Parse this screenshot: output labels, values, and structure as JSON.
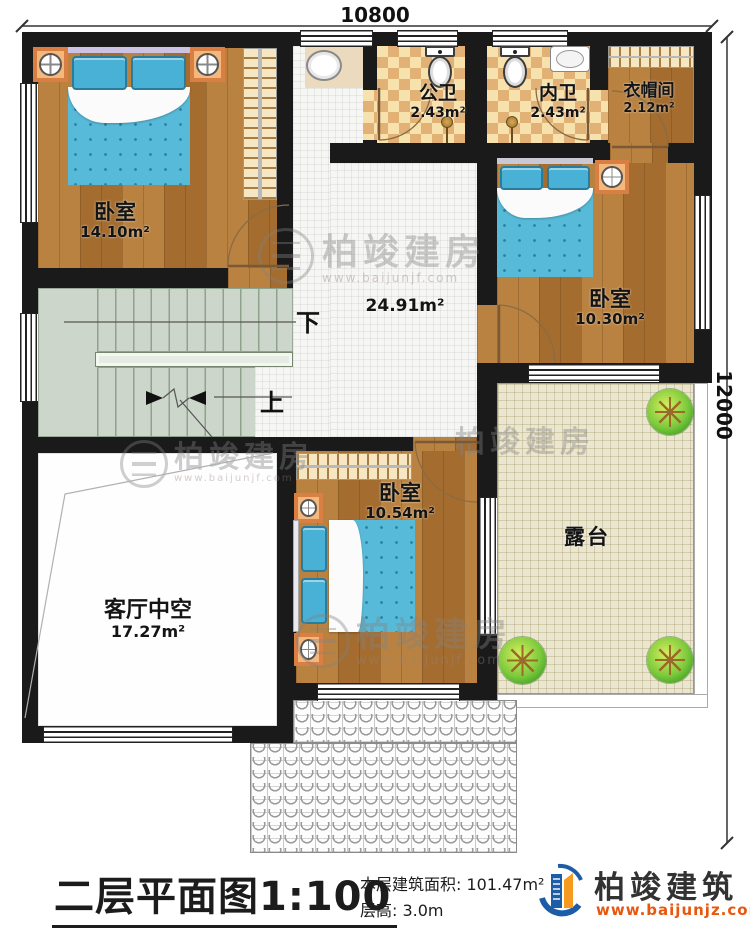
{
  "dimensions": {
    "top": "10800",
    "right": "12000"
  },
  "rooms": {
    "bedroom_tl": {
      "name": "卧室",
      "area": "14.10m²"
    },
    "bath_public": {
      "name": "公卫",
      "area": "2.43m²"
    },
    "bath_ensuite": {
      "name": "内卫",
      "area": "2.43m²"
    },
    "cloakroom": {
      "name": "衣帽间",
      "area": "2.12m²"
    },
    "bedroom_right": {
      "name": "卧室",
      "area": "10.30m²"
    },
    "hall": {
      "area": "24.91m²"
    },
    "bedroom_bottom": {
      "name": "卧室",
      "area": "10.54m²"
    },
    "living_void": {
      "name": "客厅中空",
      "area": "17.27m²"
    },
    "terrace": {
      "name": "露台"
    }
  },
  "stairs": {
    "down": "下",
    "up": "上"
  },
  "watermark": {
    "text": "柏竣建房",
    "url": "www.baijunjf.com"
  },
  "footer": {
    "title": "二层平面图",
    "scale": "1:100",
    "area_label": "本层建筑面积: 101.47m²",
    "height_label": "层高: 3.0m",
    "brand": "柏竣建筑",
    "brand_url": "www.baijunjz.com"
  }
}
